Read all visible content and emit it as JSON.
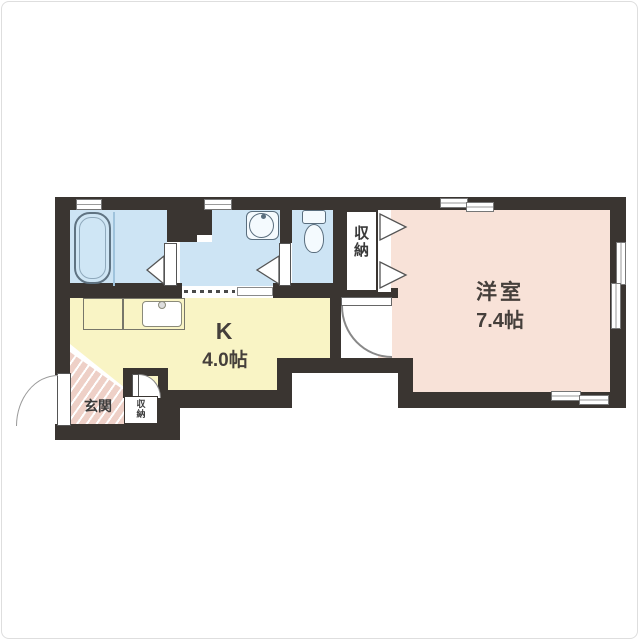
{
  "floorplan": {
    "title": "1K apartment floor plan",
    "rooms": {
      "western_room": {
        "name": "洋室",
        "size": "7.4帖"
      },
      "kitchen": {
        "name": "K",
        "size": "4.0帖"
      },
      "closet": {
        "name": "収納"
      },
      "entrance": {
        "name": "玄関"
      },
      "entrance_closet": {
        "name": "収納"
      }
    },
    "colors": {
      "wall": "#3a3531",
      "wet_area_floor": "#cde4f4",
      "western_room_floor": "#f8e2d8",
      "kitchen_floor": "#f9f4c5",
      "entrance_floor": "#eed0c7",
      "background": "#ffffff"
    }
  }
}
